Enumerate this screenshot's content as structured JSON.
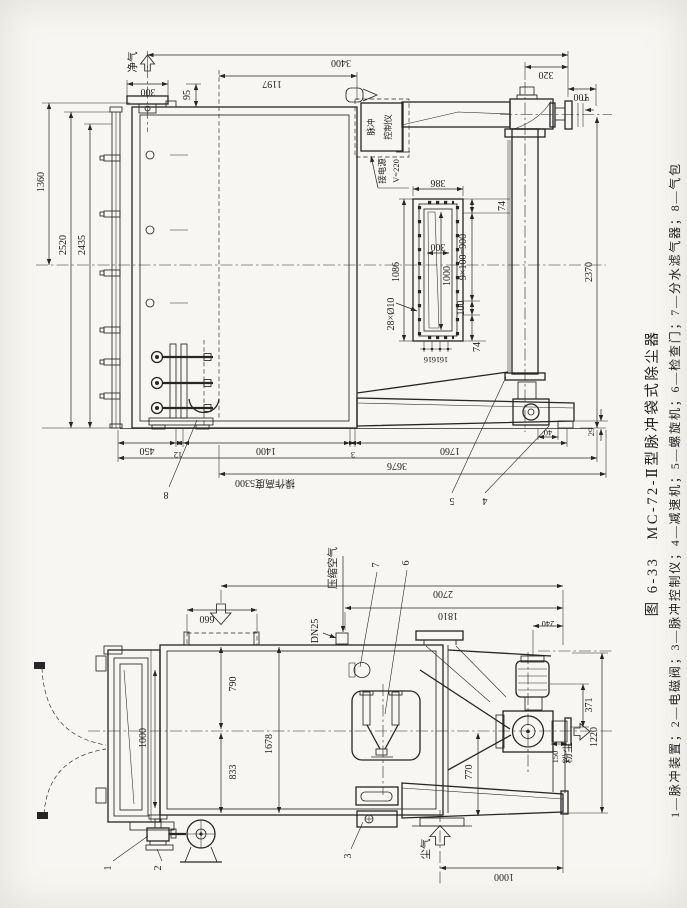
{
  "page": {
    "background": "#f7f6f2",
    "ink": "#262626"
  },
  "caption": {
    "line1": "图 6-33　MC-72-Ⅱ型脉冲袋式除尘器",
    "line2": "1—脉冲装置；2—电磁阀；3—脉冲控制仪；4—减速机；5—螺旋机；6—检查门；7—分水滤气器；8—气包"
  },
  "side_view": {
    "air_out": "净气",
    "controller_l1": "脉冲",
    "controller_l2": "控制仪",
    "power": "接电源",
    "voltage": "V=220",
    "dims": {
      "w300": "300",
      "h95": "95",
      "w3400": "3400",
      "w1197": "1197",
      "h1360": "1360",
      "h2520": "2520",
      "h2435": "2435",
      "w320": "320",
      "w100": "100",
      "g5": "5",
      "h2370": "2370",
      "f386": "386",
      "f74t": "74",
      "f9x100": "9×100=900",
      "f100": "100",
      "f74b": "74",
      "f300": "300",
      "f1000": "1000",
      "f1086": "1086",
      "f28": "28×Ø10",
      "f16a": "16",
      "f16b": "16",
      "f16c": "16",
      "b450": "450",
      "b12": "12",
      "b1400": "1400",
      "b3": "3",
      "b1760": "1760",
      "b3676": "3676",
      "b40": "40",
      "b29": "29",
      "op": "操作高度5300"
    },
    "leaders": {
      "n8": "8",
      "n5": "5",
      "n4": "4"
    }
  },
  "end_view": {
    "air_in_label": "压缩空气",
    "dn25": "DN25",
    "dust_out": "粉尘",
    "dirty_air": "尘气",
    "dims": {
      "w660": "660",
      "w2700": "2700",
      "w1810": "1810",
      "w240": "240",
      "h790": "790",
      "h833": "833",
      "h1678": "1678",
      "door1000": "1000",
      "h770": "770",
      "h371": "371",
      "h150": "150",
      "h1220": "1220",
      "b1000": "1000"
    },
    "leaders": {
      "n1": "1",
      "n2": "2",
      "n3": "3",
      "n6": "6",
      "n7": "7"
    }
  }
}
